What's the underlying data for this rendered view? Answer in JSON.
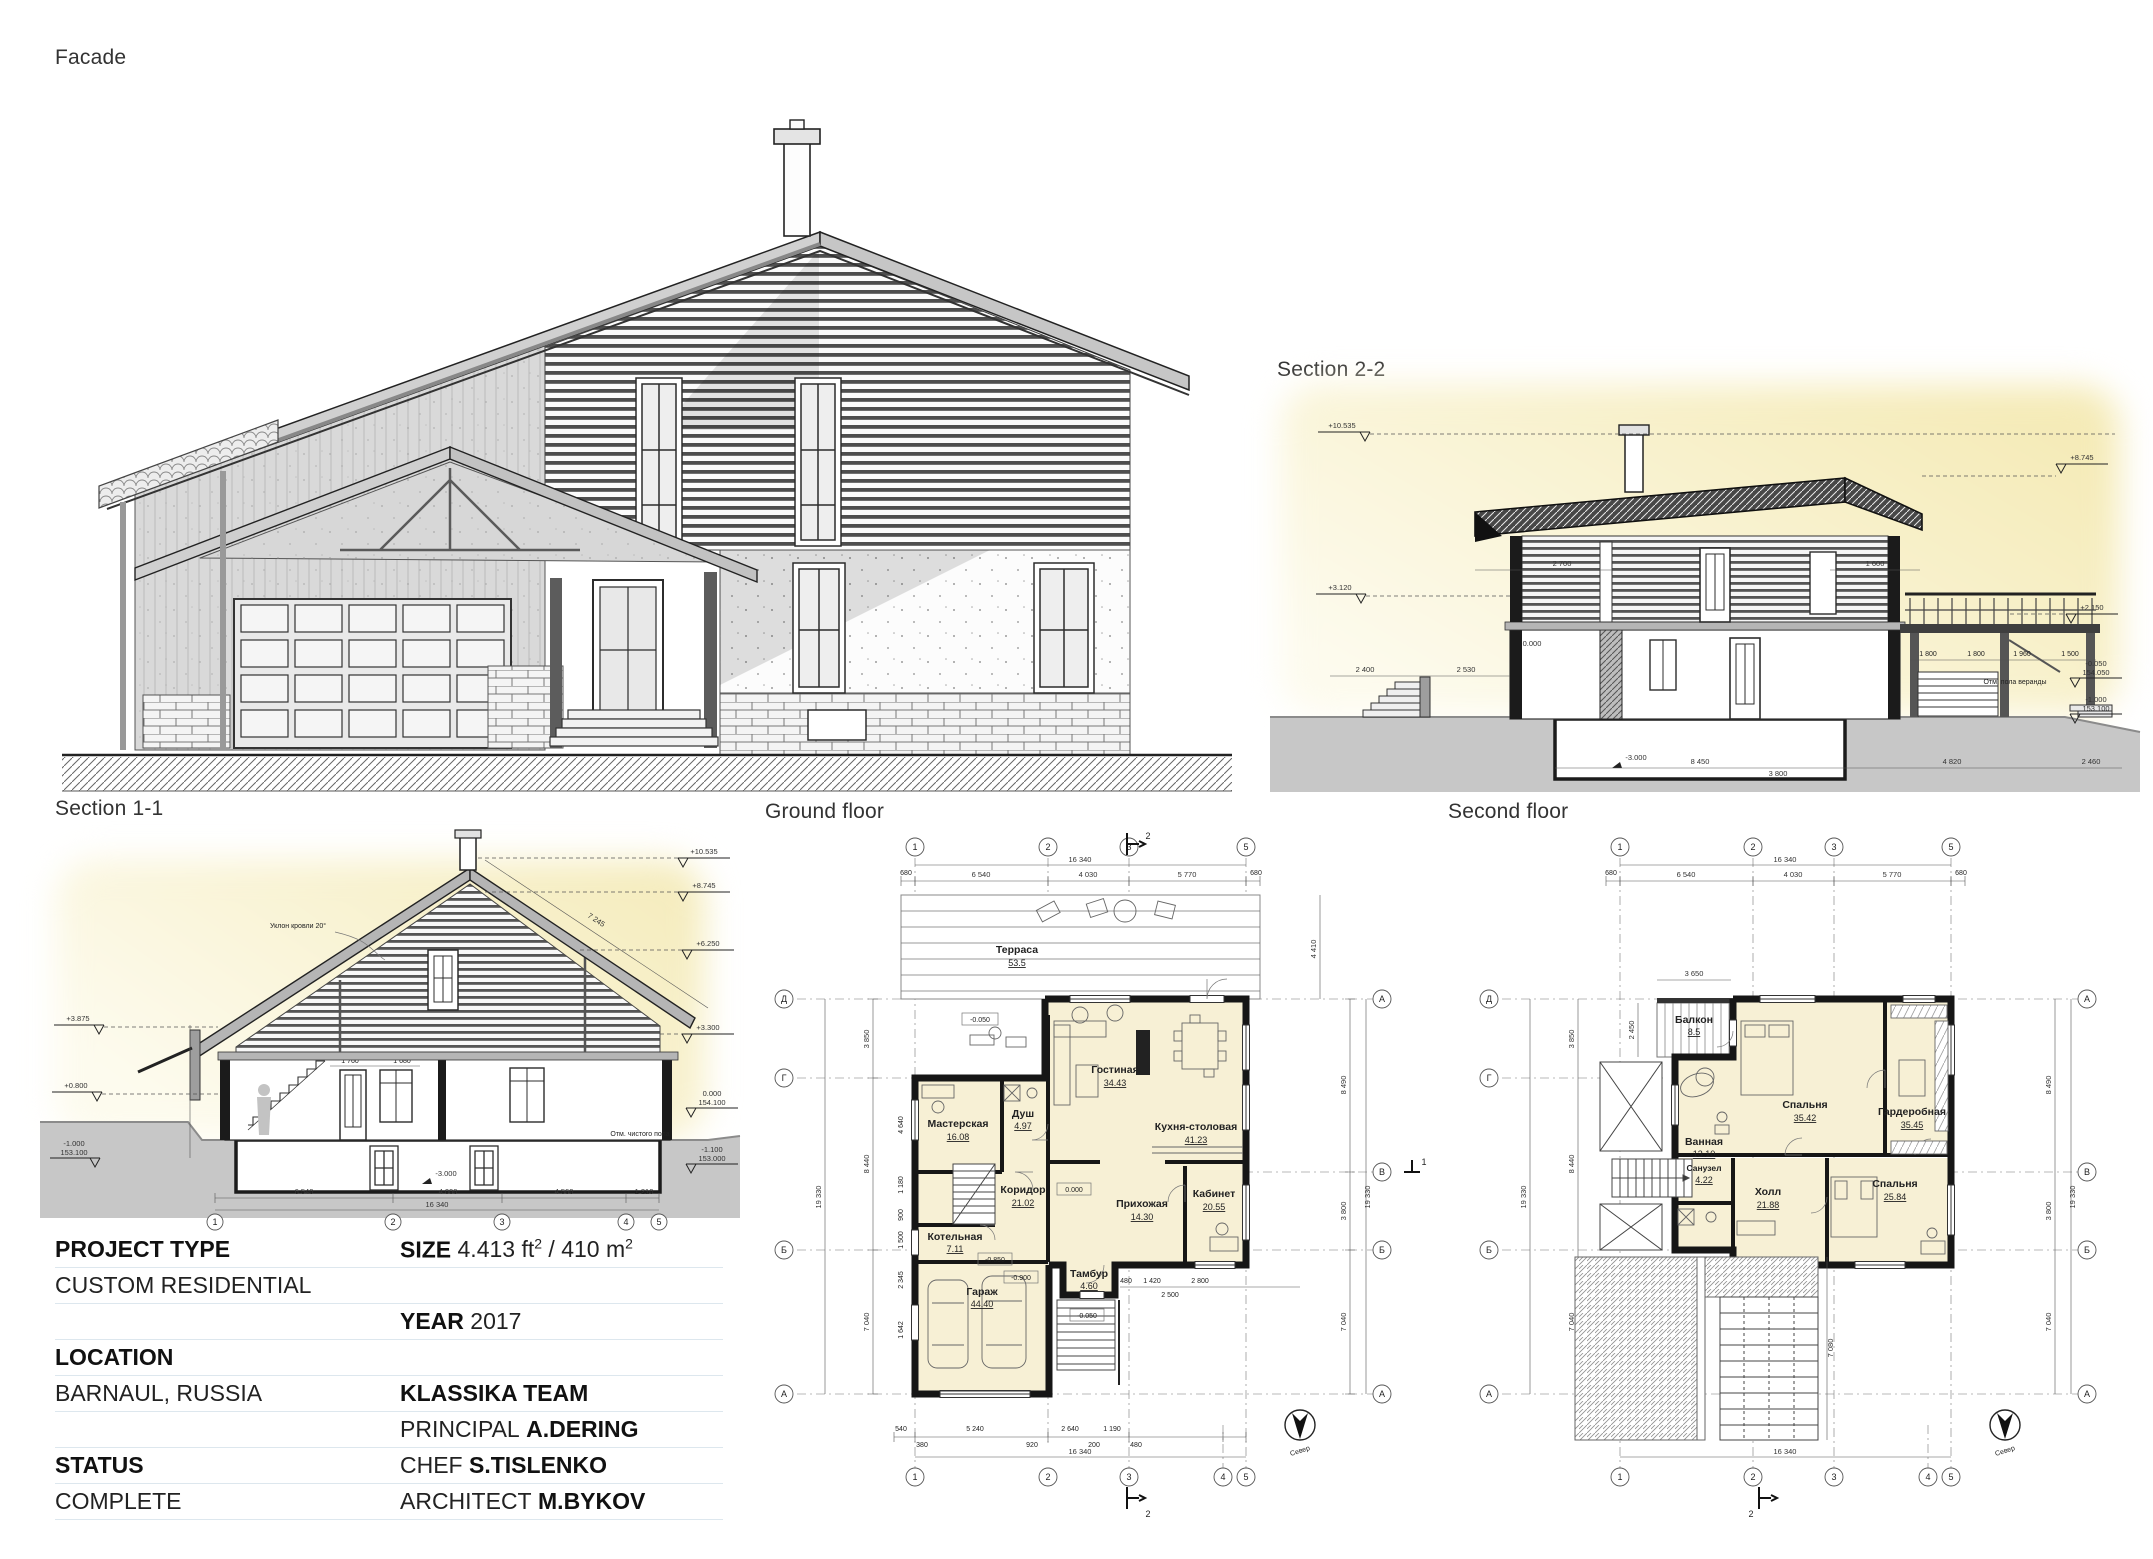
{
  "titles": {
    "facade": "Facade",
    "section_2_2": "Section 2-2",
    "section_1_1": "Section 1-1",
    "ground_floor": "Ground floor",
    "second_floor": "Second floor"
  },
  "info_table": {
    "project_type_label": "PROJECT TYPE",
    "project_type_value": "CUSTOM RESIDENTIAL",
    "size_label": "SIZE",
    "size_value_1": "4.413 ft",
    "size_sup_1": "2",
    "size_value_2": " / 410 m",
    "size_sup_2": "2",
    "year_label": "YEAR",
    "year_value": "2017",
    "location_label": "LOCATION",
    "location_value": "BARNAUL, RUSSIA",
    "team": "KLASSIKA TEAM",
    "principal_label": "PRINCIPAL",
    "principal_value": "A.DERING",
    "chef_label": "CHEF",
    "chef_value": "S.TISLENKO",
    "architect_label": "ARCHITECT",
    "architect_value": "M.BYKOV",
    "status_label": "STATUS",
    "status_value": "COMPLETE"
  },
  "colors": {
    "accent_yellow": "#f6edc2",
    "room_fill": "#f7f0d5",
    "ground_gray": "#c7c7c7",
    "line": "#161616"
  },
  "ground_floor": {
    "rooms": [
      {
        "name": "Терраса",
        "area": "53.5"
      },
      {
        "name": "Гостиная",
        "area": "34.43"
      },
      {
        "name": "Кухня-столовая",
        "area": "41.23"
      },
      {
        "name": "Мастерская",
        "area": "16.08"
      },
      {
        "name": "Душ",
        "area": "4.97"
      },
      {
        "name": "Коридор",
        "area": "21.02"
      },
      {
        "name": "Прихожая",
        "area": "14.30"
      },
      {
        "name": "Кабинет",
        "area": "20.55"
      },
      {
        "name": "Котельная",
        "area": "7.11"
      },
      {
        "name": "Тамбур",
        "area": "4.60"
      },
      {
        "name": "Гараж",
        "area": "44.40"
      }
    ],
    "levels": {
      "terrace": "-0.050",
      "hall": "0.000",
      "garage_a": "-0.850",
      "garage_b": "-0.900",
      "vest": "-0.050"
    },
    "grid_cols_top": [
      "1",
      "2",
      "3",
      "5"
    ],
    "grid_cols_bottom": [
      "1",
      "2",
      "3",
      "4",
      "5"
    ],
    "grid_rows_left": [
      "Д",
      "Г",
      "Б",
      "А"
    ],
    "grid_rows_right": [
      "А",
      "В",
      "Б",
      "А"
    ],
    "dim_total": "16 340",
    "dims_top": [
      "680",
      "6 540",
      "4 030",
      "5 770",
      "680"
    ],
    "dims_bottom": [
      "540",
      "380",
      "5 240",
      "920",
      "2 640",
      "200",
      "1 190",
      "480"
    ],
    "dims_left": [
      "3 850",
      "8 440",
      "7 040"
    ],
    "dims_left_inner": [
      "4 640",
      "1 180",
      "900",
      "1 500",
      "2 345",
      "1 642"
    ],
    "dim_left_total": "19 330",
    "dims_right": [
      "8 490",
      "3 800",
      "7 040"
    ],
    "dim_right_total": "19 330",
    "dim_terrace": "4 410",
    "dims_inner": [
      "480",
      "1 420",
      "2 800",
      "2 500"
    ],
    "cut_2": "2",
    "cut_1": "1",
    "north": "Север"
  },
  "second_floor": {
    "rooms": [
      {
        "name": "Балкон",
        "area": "8.5"
      },
      {
        "name": "Спальня",
        "area": "35.42"
      },
      {
        "name": "Гардеробная",
        "area": "35.45"
      },
      {
        "name": "Ванная",
        "area": "13.10"
      },
      {
        "name": "Холл",
        "area": "21.88"
      },
      {
        "name": "Спальня",
        "area": "25.84"
      },
      {
        "name": "Санузел",
        "area": "4.22"
      }
    ],
    "grid_cols_top": [
      "1",
      "2",
      "3",
      "5"
    ],
    "grid_cols_bottom": [
      "1",
      "2",
      "3",
      "4",
      "5"
    ],
    "grid_rows_left": [
      "Д",
      "Г",
      "Б",
      "А"
    ],
    "grid_rows_right": [
      "А",
      "В",
      "Б",
      "А"
    ],
    "dim_total": "16 340",
    "dims_top": [
      "680",
      "6 540",
      "4 030",
      "5 770",
      "680"
    ],
    "dims_left": [
      "3 850",
      "8 440",
      "7 040"
    ],
    "dim_left_total": "19 330",
    "dims_right": [
      "8 490",
      "3 800",
      "7 040"
    ],
    "dim_right_total": "19 330",
    "dim_balcony_w": "3 650",
    "dim_balcony_h": "2 450",
    "dim_pergola": "7 080",
    "cut_2": "2",
    "north": "Север"
  },
  "section_1_1": {
    "roof_note": "Уклон кровли 20°",
    "roof_dim": "7 245",
    "elev_left": [
      "+3.875",
      "+0.800",
      "-1.000",
      "153.100"
    ],
    "elev_right": [
      "+10.535",
      "+8.745",
      "+6.250",
      "+3.300",
      "0.000",
      "154.100",
      "-1.100",
      "153.000"
    ],
    "floor_note": "Отм. чистого пола",
    "basement_level": "-3.000",
    "dims_bottom": [
      "6 540",
      "4 000",
      "4 560",
      "1 210"
    ],
    "dim_total": "16 340",
    "dims_inner": [
      "1 760",
      "580",
      "1 680"
    ],
    "grid": [
      "1",
      "2",
      "3",
      "4",
      "5"
    ]
  },
  "section_2_2": {
    "elev_left": [
      "+10.535",
      "+3.120"
    ],
    "elev_right": [
      "+8.745",
      "+2.150",
      "-0.050",
      "154.050",
      "-1.000",
      "153.100"
    ],
    "level_zero": "0.000",
    "veranda_note": "Отм. пола веранды",
    "basement_level": "-3.000",
    "dims_roof": [
      "2 700",
      "1 600"
    ],
    "dims_left": [
      "2 400",
      "2 530"
    ],
    "dims_bottom": [
      "8 450",
      "3 800",
      "4 820",
      "2 460"
    ],
    "dims_terrace": [
      "1 800",
      "1 800",
      "1 960",
      "1 500"
    ]
  }
}
